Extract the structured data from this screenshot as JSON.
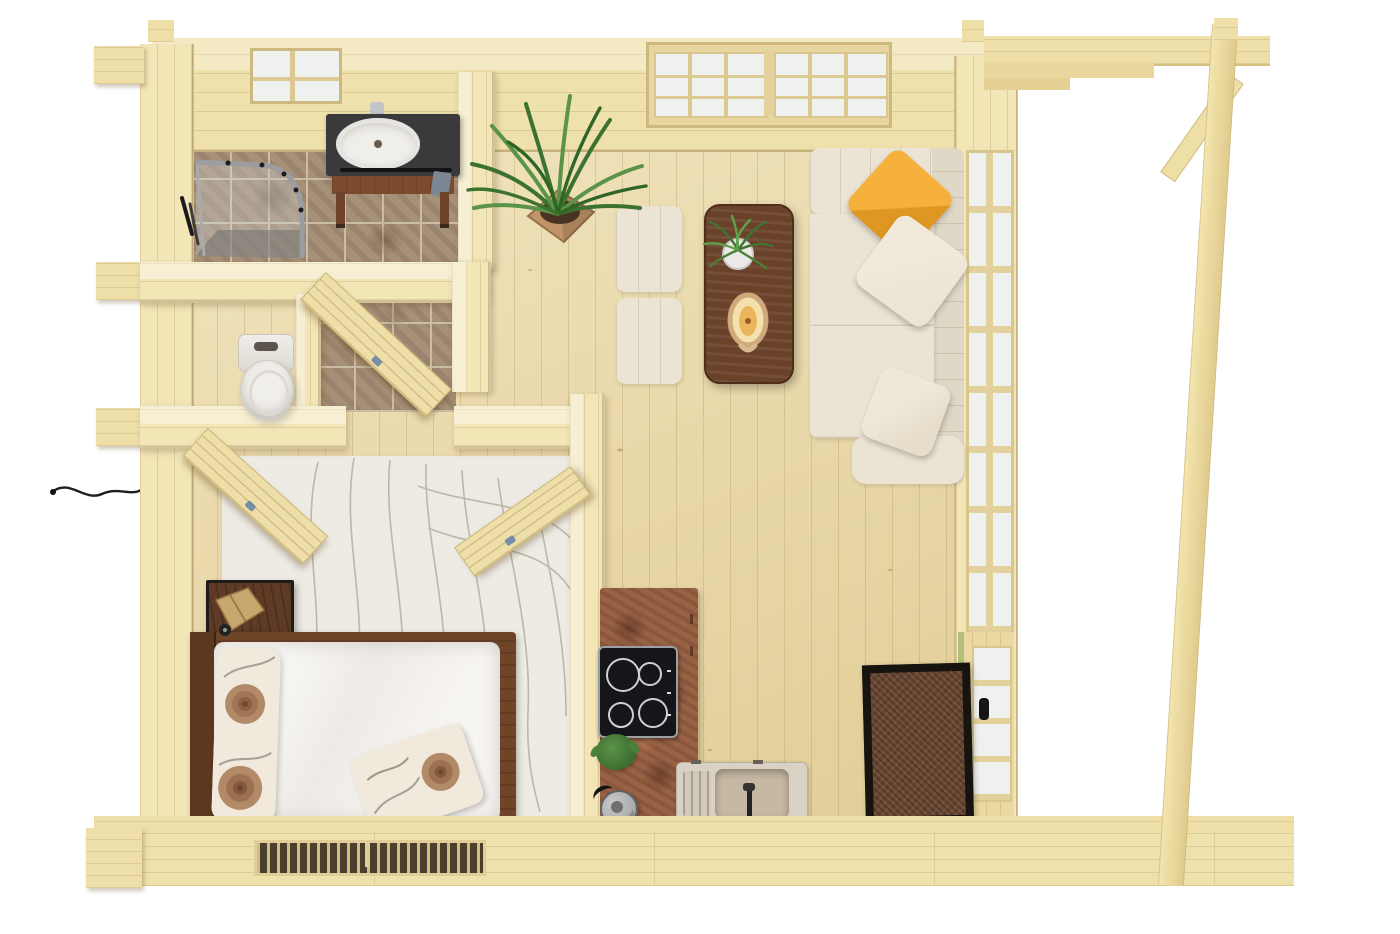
{
  "scene": {
    "type": "3d-floor-plan-render",
    "subject": "log-cabin-studio-house",
    "view": "top-down",
    "background": "white"
  },
  "colors": {
    "background": "#ffffff",
    "wood_floor": "#ead8a3",
    "wood_wall": "#efe1ac",
    "wood_wall_v": "#f2e5b6",
    "wood_beam": "#eedfa8",
    "door_wood": "#eedfa8",
    "tile_base": "#a79078",
    "tile_grout": "#cbbda4",
    "rust_counter": "#9a6245",
    "cooktop_black": "#16161a",
    "burner_ring": "#ccd1d5",
    "sofa_cream": "#ebe4d5",
    "sofa_cream_dark": "#e0d8c6",
    "pillow_yellow": "#f0a730",
    "pillow_cream": "#ece4d4",
    "table_walnut": "#6a4129",
    "rug_cream": "#edebe4",
    "rug_line": "#b3afa3",
    "bed_frame": "#6f4528",
    "headboard": "#5d3820",
    "duvet_white": "#f3f1ee",
    "floral_cream": "#f0e9dc",
    "floral_brown": "#ab8160",
    "mat_border": "#17130f",
    "mat_center": "#6b4832",
    "porcelain": "#f0eeea",
    "shower_frame": "#9b9da0",
    "vanity_counter": "#3a393b",
    "vanity_wood": "#7c4b2e",
    "towel_blue": "#7b8794",
    "glass_white": "#eff1ef",
    "door_green": "#b0bf7a",
    "handle_black": "#161616",
    "kettle_gray": "#a9abad",
    "sink_stone": "#d8d1c4",
    "sink_bowl": "#c6b9a4",
    "lamp_wood": "#c8a76f",
    "metal_black": "#1f1d1b",
    "plant_green": "#3c722f",
    "plant_green_light": "#5b9348",
    "pot_tan": "#c09468",
    "soil_brown": "#4a3322",
    "fern_green": "#3f7434",
    "lantern_tan": "#cfa97b",
    "lantern_inner": "#f3e0ad",
    "candle": "#e9b65c"
  },
  "rooms": [
    {
      "name": "bathroom",
      "features": [
        "corner-shower",
        "vanity-sink",
        "small-window",
        "tile-floor"
      ]
    },
    {
      "name": "wc",
      "features": [
        "toilet"
      ]
    },
    {
      "name": "hallway",
      "features": [
        "bathroom-door",
        "bedroom-door",
        "hall-door"
      ]
    },
    {
      "name": "bedroom",
      "features": [
        "double-bed",
        "floral-pillows",
        "nightstand",
        "lamp",
        "contour-rug"
      ]
    },
    {
      "name": "living-room",
      "features": [
        "corner-sofa",
        "yellow-pillow",
        "coffee-table",
        "ottoman",
        "palm-plant",
        "picture-window",
        "glazed-wall"
      ]
    },
    {
      "name": "kitchen",
      "features": [
        "l-shaped-counter",
        "induction-hob",
        "kitchen-sink",
        "kettle",
        "herb-plant"
      ]
    },
    {
      "name": "entrance",
      "features": [
        "glazed-door",
        "doormat"
      ]
    },
    {
      "name": "porch",
      "features": [
        "header-beam",
        "corner-post",
        "diagonal-brace"
      ]
    }
  ]
}
